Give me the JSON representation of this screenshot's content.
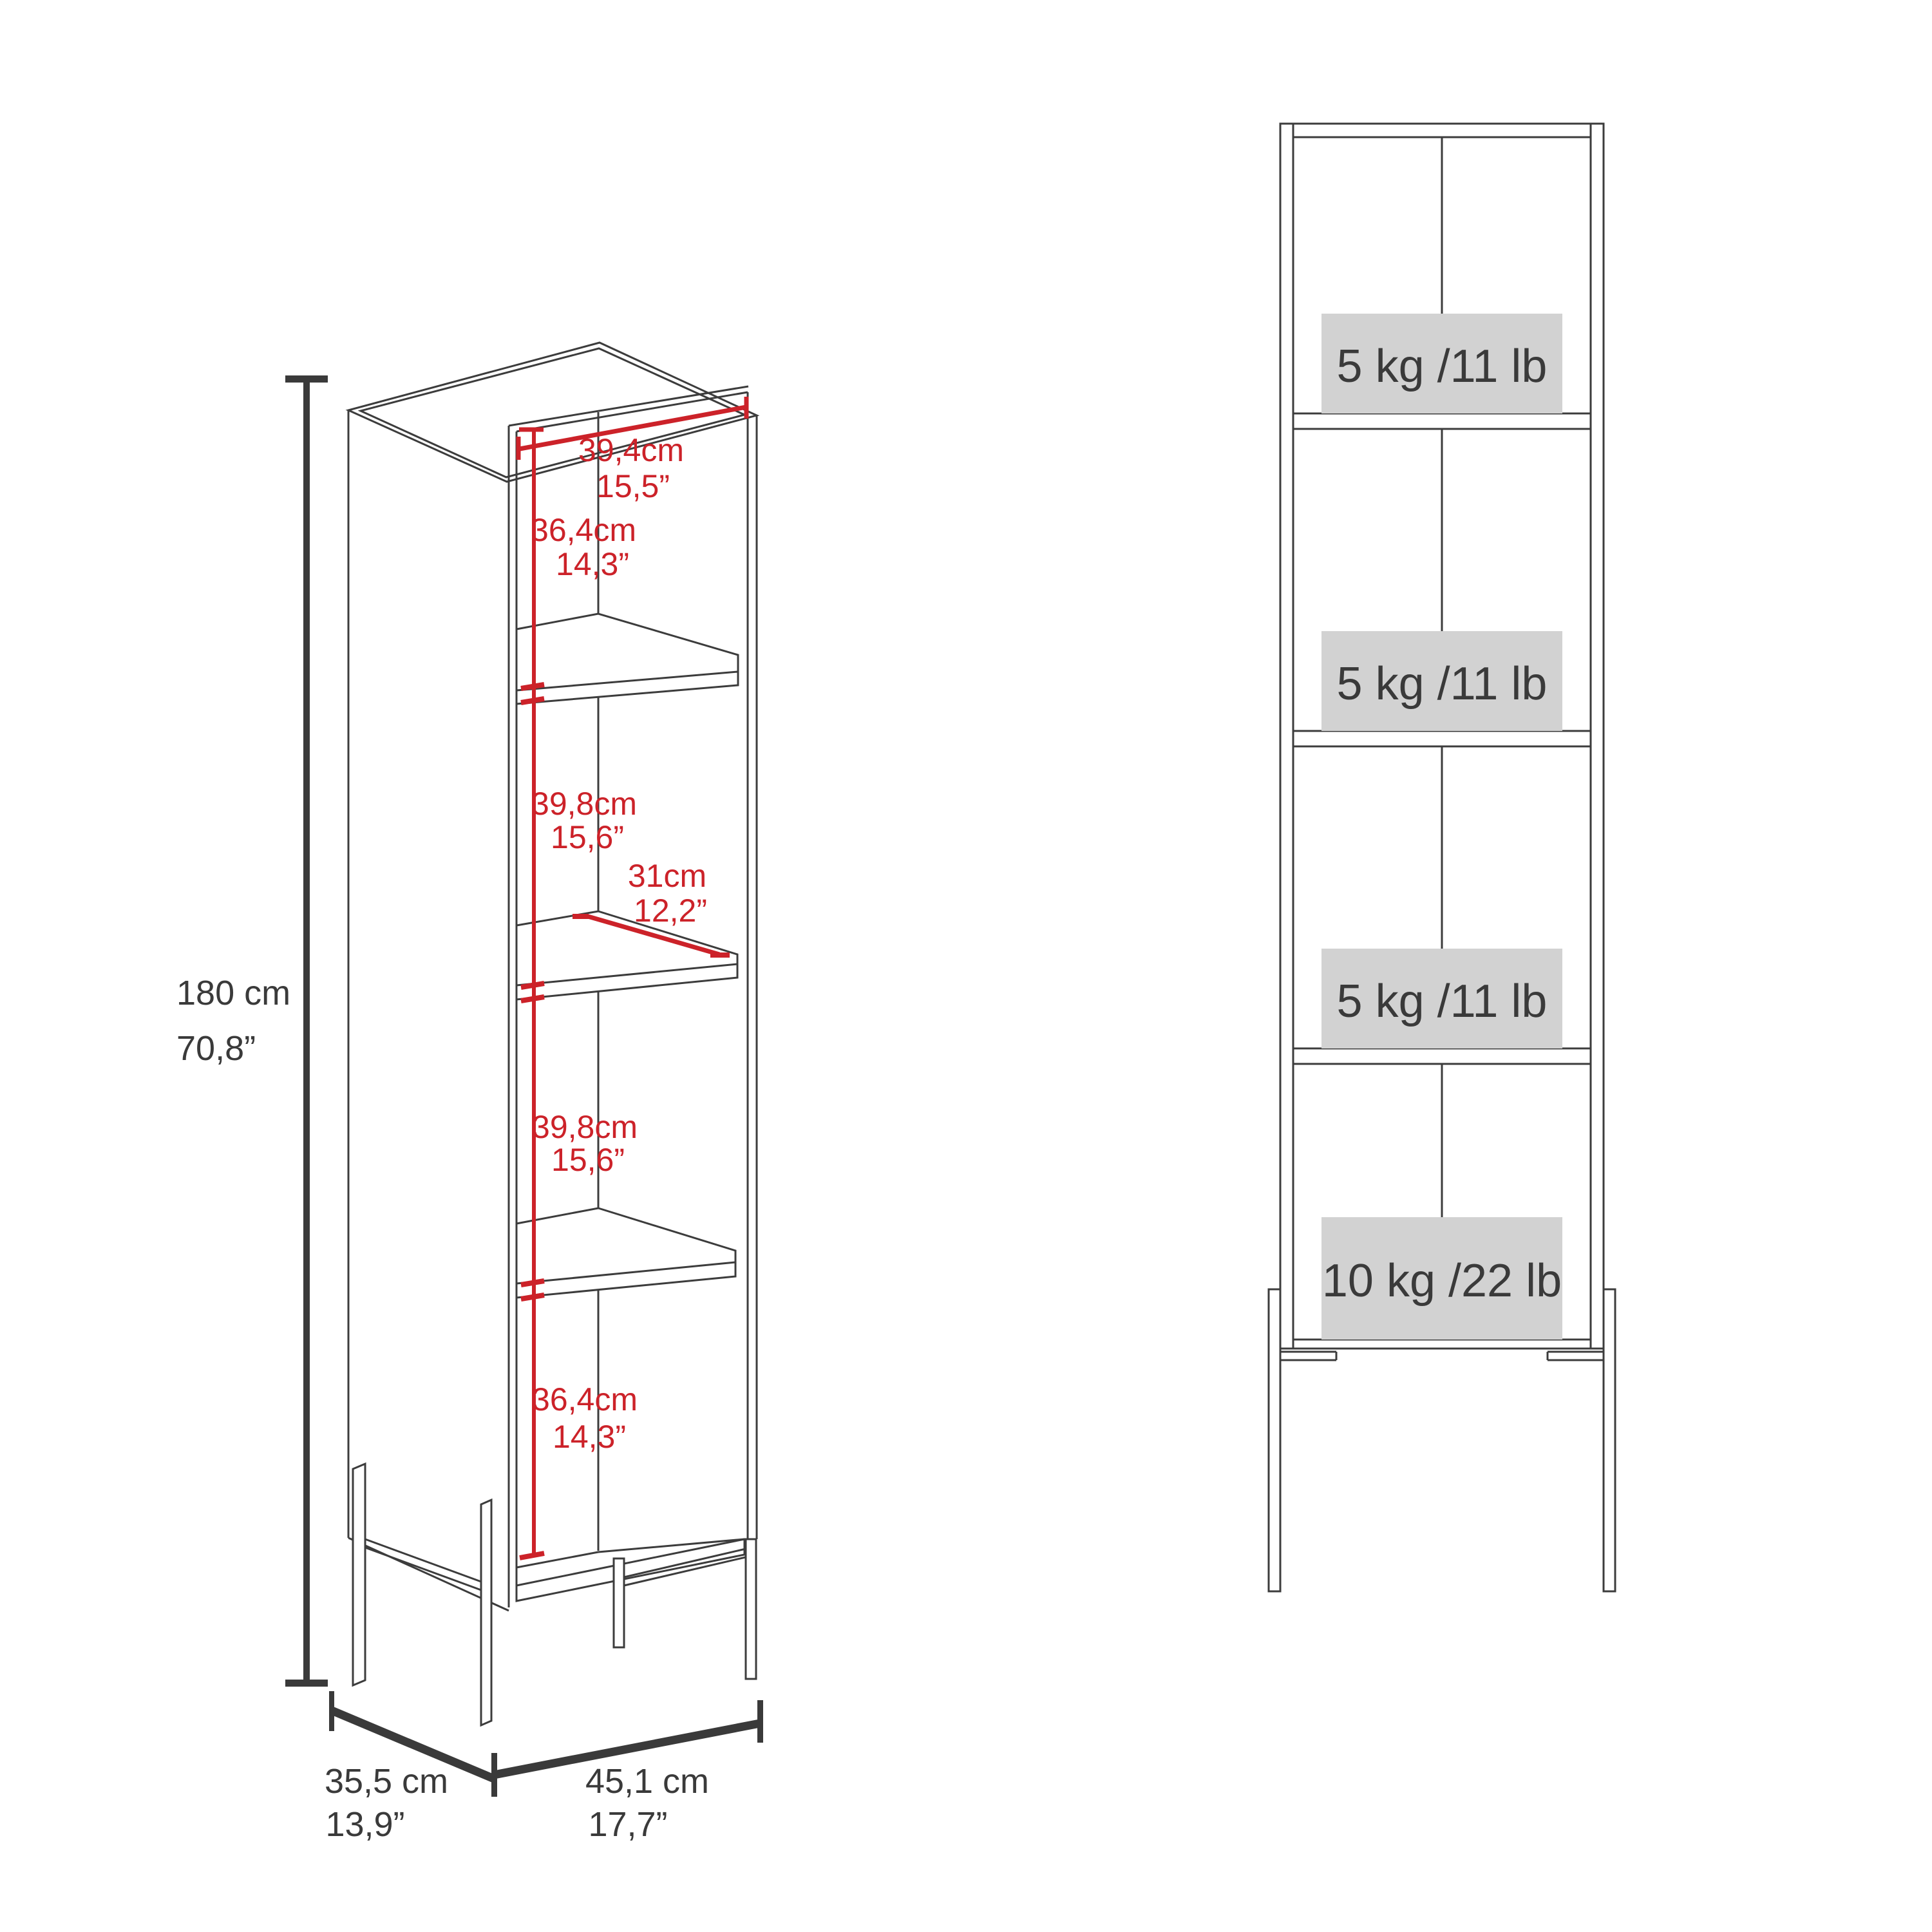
{
  "diagram_type": "furniture-dimension-spec",
  "colors": {
    "red": "#cc2229",
    "line": "#3c3c3c",
    "text": "#3a3a3a",
    "load_box_fill": "#d2d2d2"
  },
  "perspective_view": {
    "overall": {
      "height_cm": "180 cm",
      "height_in": "70,8”",
      "depth_cm": "35,5 cm",
      "depth_in": "13,9”",
      "width_cm": "45,1 cm",
      "width_in": "17,7”"
    },
    "interior": {
      "top_width": {
        "cm": "39,4cm",
        "in": "15,5”"
      },
      "section1": {
        "cm": "36,4cm",
        "in": "14,3”"
      },
      "section2": {
        "cm": "39,8cm",
        "in": "15,6”"
      },
      "shelf_depth": {
        "cm": "31cm",
        "in": "12,2”"
      },
      "section3": {
        "cm": "39,8cm",
        "in": "15,6”"
      },
      "section4": {
        "cm": "36,4cm",
        "in": "14,3”"
      }
    }
  },
  "front_view": {
    "loads": [
      {
        "label": "5 kg /11 lb"
      },
      {
        "label": "5 kg /11 lb"
      },
      {
        "label": "5 kg /11 lb"
      },
      {
        "label": "10 kg /22 lb"
      }
    ]
  }
}
